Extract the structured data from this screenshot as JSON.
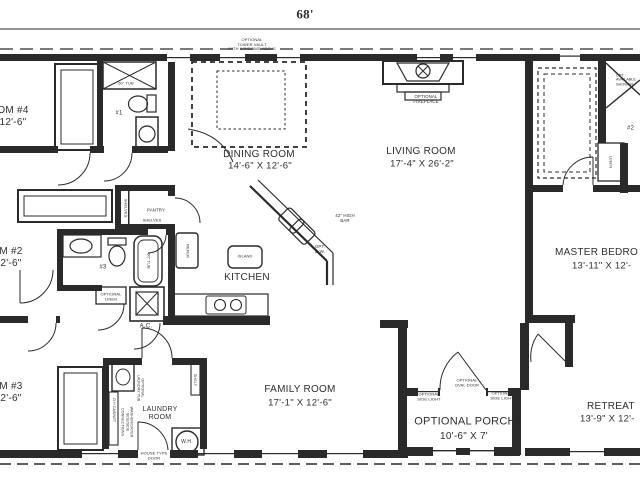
{
  "plan": {
    "total_width": "68'",
    "colors": {
      "ink": "#2a2a2a",
      "bg": "#ffffff"
    },
    "rooms": {
      "dining": {
        "name": "DINING ROOM",
        "dims": "14'-6\" X 12'-6\""
      },
      "living": {
        "name": "LIVING ROOM",
        "dims": "17'-4\" X 26'-2\""
      },
      "kitchen": {
        "name": "KITCHEN"
      },
      "family": {
        "name": "FAMILY ROOM",
        "dims": "17'-1\" X 12'-6\""
      },
      "laundry": {
        "name": "LAUNDRY\nROOM"
      },
      "porch": {
        "name": "OPTIONAL PORCH",
        "dims": "10'-6\" X 7'"
      },
      "retreat": {
        "name": "RETREAT",
        "dims": "13'-9\" X 12'-"
      },
      "master": {
        "name": "MASTER BEDRO",
        "dims": "13'-11\" X 12'-"
      },
      "bedroom4": {
        "name": "OM #4\n12'-6\""
      },
      "bedroom2": {
        "name": "M #2\n2'-6\""
      },
      "bedroom3": {
        "name": "M #3\n2'-6\""
      }
    },
    "notes": {
      "tower_vault": "OPTIONAL\nTOWER VAULT\nWITH WINDOWS ABOVE",
      "fireplace": "OPTIONAL\nFIREPLACE",
      "bar": "42\" HIGH\nBAR",
      "dishwasher": "OPT.\nD.W.",
      "corner_shower": "OPT.\nAVAILABLE\nSHOWER",
      "oval_door": "OPTIONAL\nOVAL DOOR",
      "side_light_left": "OPTIONAL\nSIDE LIGHT",
      "side_light_right": "OPTIONAL\nSIDE LIGHT",
      "house_type_door": "HOUSE TYPE\nDOOR",
      "optional_linen": "OPTIONAL\nLINEN"
    },
    "fixtures": {
      "bath1": "#1",
      "bath2": "#2",
      "bath3": "#3",
      "tub1": "60\" TUB",
      "tub3": "60\" TUB",
      "pantry": "PANTRY",
      "shelves_side": "SHELVES",
      "shelves_bottom": "SHELVES",
      "refrigerator": "REFER",
      "island": "ISLAND",
      "ac_unit": "A.C.",
      "linen": "LINEN",
      "shelf": "SHELF",
      "water_heater": "W.H.",
      "oh_cabinet": "O.H CABINET",
      "wd_connections": "WASHER/DRYER\nSIDE/SIDE\nCONNECTIONS",
      "laundry_tub": "OPTIONAL\nLAUNDRY TUB"
    }
  }
}
